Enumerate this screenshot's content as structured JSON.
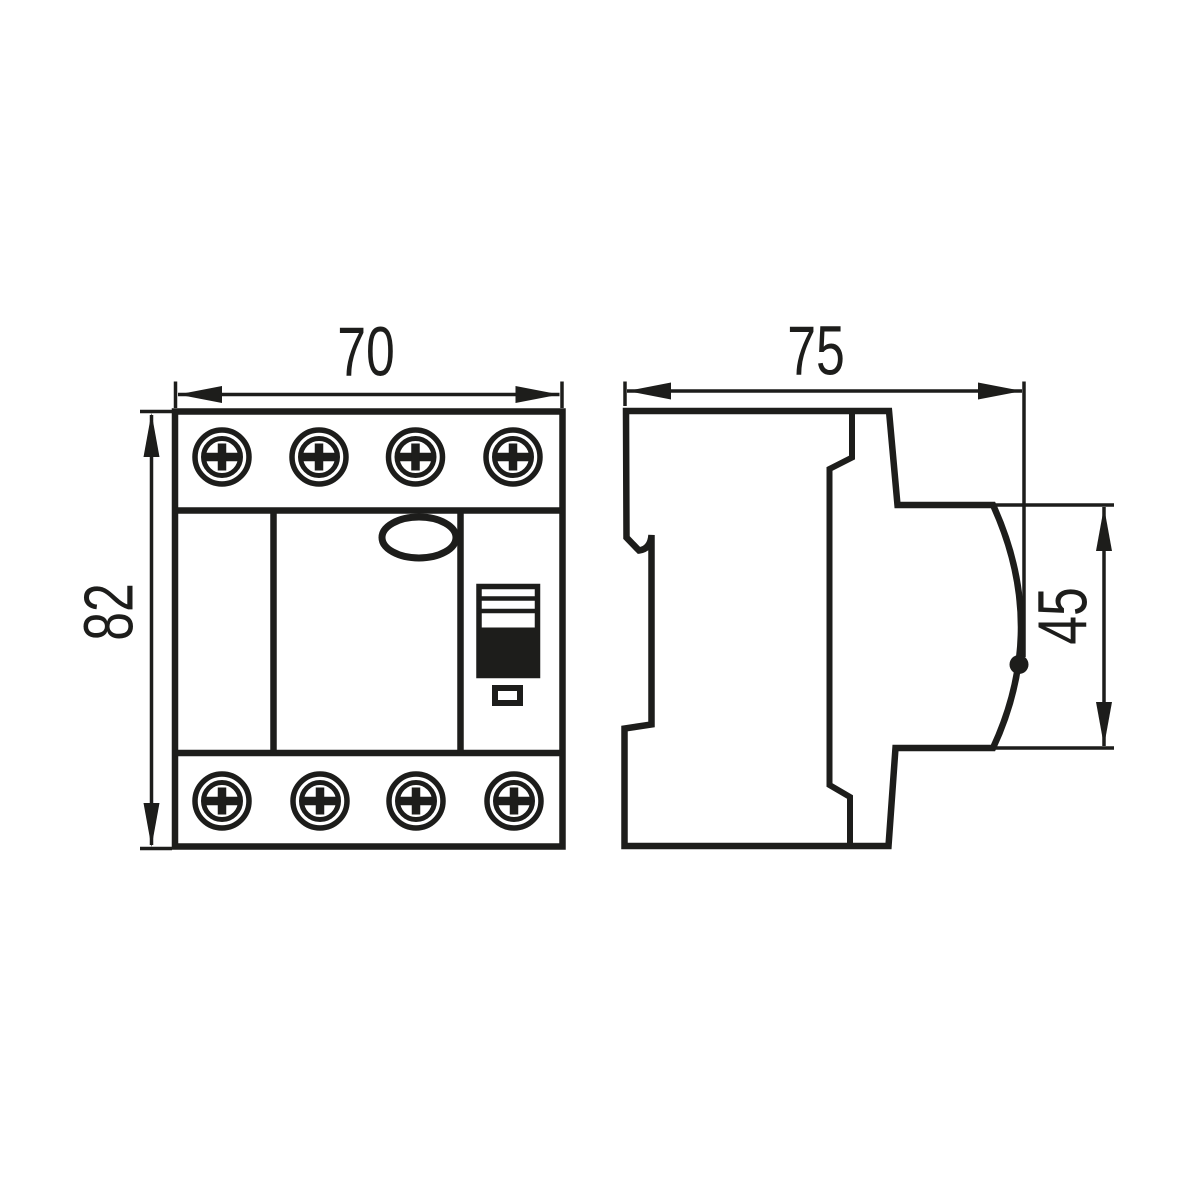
{
  "drawing": {
    "kind": "technical-dimension-drawing",
    "colors": {
      "ink": "#1d1d1b",
      "paper": "#ffffff",
      "switch_handle_fill": "#1d1d1b"
    },
    "front_view": {
      "width_label": "70",
      "height_label": "82",
      "screws_top": 4,
      "screws_bottom": 4
    },
    "side_view": {
      "depth_label": "75",
      "face_height_label": "45"
    }
  }
}
